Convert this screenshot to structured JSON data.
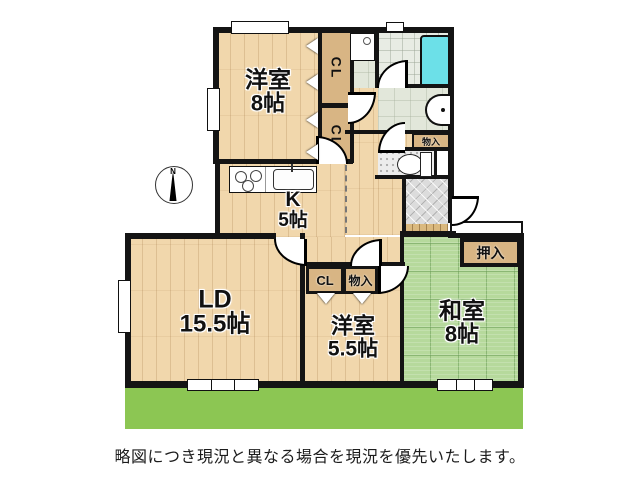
{
  "caption": "略図につき現況と異なる場合を現況を優先いたします。",
  "compass": {
    "label": "N"
  },
  "rooms": {
    "yoshitsu8": {
      "name": "洋室",
      "size": "8帖"
    },
    "kitchen": {
      "name": "K",
      "size": "5帖"
    },
    "ld": {
      "name": "LD",
      "size": "15.5帖"
    },
    "yoshitsu55": {
      "name": "洋室",
      "size": "5.5帖"
    },
    "washitsu": {
      "name": "和室",
      "size": "8帖"
    }
  },
  "closets": {
    "cl_upper": {
      "label": "CL"
    },
    "cl_lower": {
      "label": "CL"
    },
    "cl_hall": {
      "label": "CL"
    },
    "storage_hall": {
      "label": "物入"
    },
    "storage_wash": {
      "label": "物入"
    },
    "oshiire": {
      "label": "押入"
    }
  },
  "colors": {
    "wood": "#f1d7ac",
    "tatami": "#b6d99c",
    "closet_tan": "#d8b584",
    "garden_green": "#8cc653",
    "bathtub_cyan": "#6ce0e8",
    "wall_black": "#141414"
  }
}
